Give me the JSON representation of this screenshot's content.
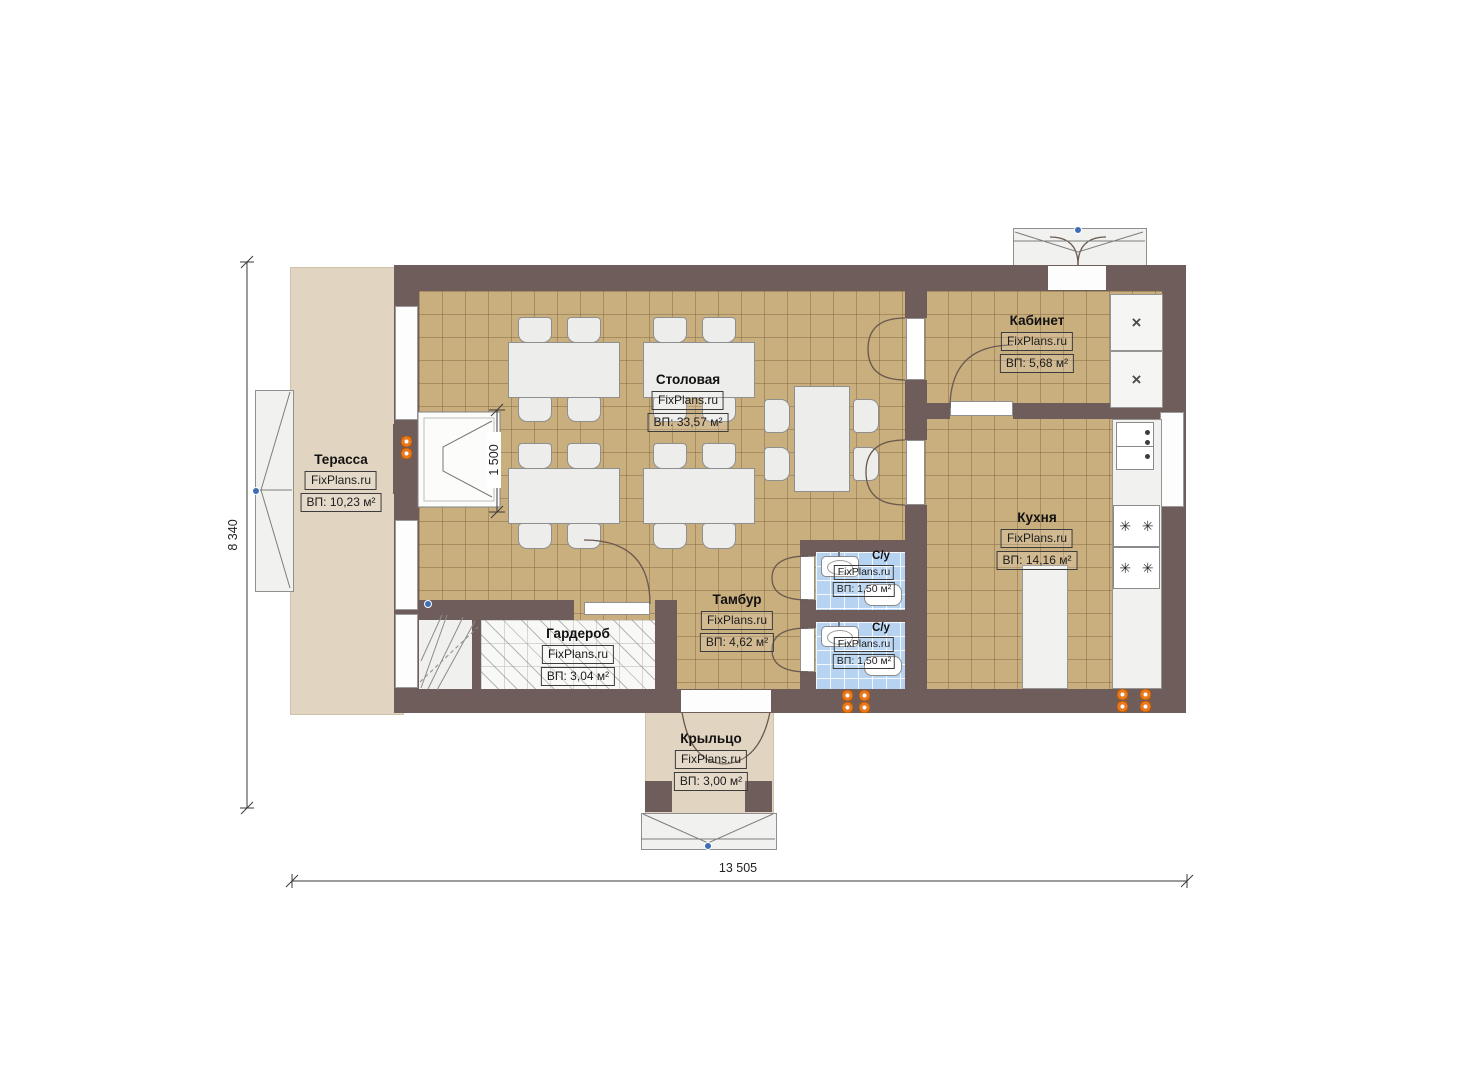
{
  "plan": {
    "brand": "FixPlans.ru",
    "rooms": [
      {
        "name": "Терасса",
        "area": "ВП: 10,23 м²"
      },
      {
        "name": "Столовая",
        "area": "ВП: 33,57 м²"
      },
      {
        "name": "Кабинет",
        "area": "ВП: 5,68 м²"
      },
      {
        "name": "Кухня",
        "area": "ВП: 14,16 м²"
      },
      {
        "name": "С/у",
        "area": "ВП: 1,50 м²"
      },
      {
        "name": "С/у",
        "area": "ВП: 1,50 м²"
      },
      {
        "name": "Тамбур",
        "area": "ВП: 4,62 м²"
      },
      {
        "name": "Гардероб",
        "area": "ВП: 3,04 м²"
      },
      {
        "name": "Крыльцо",
        "area": "ВП: 3,00 м²"
      }
    ],
    "dimensions": {
      "overall_width": "13 505",
      "overall_height": "8 340",
      "fireplace_width": "1 500"
    },
    "symbols": {
      "cabinet_cross": "×",
      "burner": "✳"
    },
    "colors": {
      "wall": "#6f5d5c",
      "tile_floor": "#c9ae7e",
      "terrace_floor": "#e1d4c0",
      "bath_floor": "#b6d3f1",
      "radiator": "#e8791e"
    }
  }
}
